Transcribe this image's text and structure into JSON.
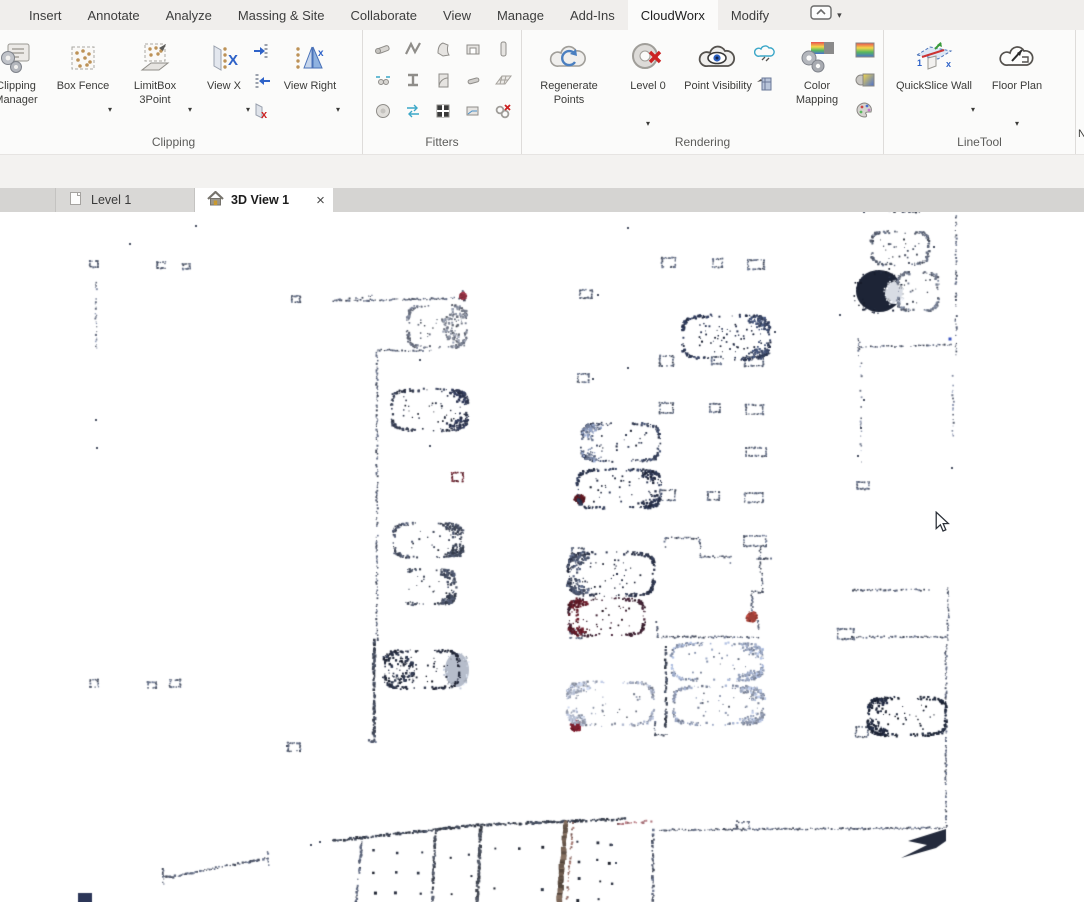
{
  "menu": {
    "tabs": [
      "Insert",
      "Annotate",
      "Analyze",
      "Massing & Site",
      "Collaborate",
      "View",
      "Manage",
      "Add-Ins",
      "CloudWorx",
      "Modify"
    ],
    "active_tab": "CloudWorx"
  },
  "ribbon": {
    "clipping": {
      "label": "Clipping",
      "manager": "Clipping Manager",
      "box_fence": "Box Fence",
      "limitbox": "LimitBox 3Point",
      "view_x": "View X",
      "view_right": "View Right"
    },
    "fitters": {
      "label": "Fitters"
    },
    "rendering": {
      "label": "Rendering",
      "regenerate": "Regenerate Points",
      "level": "Level 0",
      "visibility": "Point Visibility",
      "mapping": "Color Mapping"
    },
    "linetool": {
      "label": "LineTool",
      "quickslice": "QuickSlice Wall",
      "floorplan": "Floor Plan"
    },
    "edge_fragment": "N"
  },
  "view_tabs": {
    "level1": "Level 1",
    "view3d": "3D View 1",
    "close": "×"
  },
  "colors": {
    "accent_blue": "#2e62c8",
    "point_navy": "#2a3450",
    "tan_dot": "#bd9257",
    "red_mark": "#cc2222"
  },
  "scene": {
    "walls": [
      {
        "p": [
          330,
          301,
          464,
          298
        ]
      },
      {
        "p": [
          372,
          296,
          332,
          301
        ],
        "g": 0.55
      },
      {
        "p": [
          463,
          291,
          464,
          300
        ],
        "w": 2
      },
      {
        "p": [
          378,
          350,
          431,
          351
        ]
      },
      {
        "p": [
          377,
          351,
          377,
          640
        ],
        "g": 0.38
      },
      {
        "p": [
          374,
          640,
          374,
          741
        ],
        "w": 2.4,
        "g": 0.12,
        "c": "#3f4656"
      },
      {
        "p": [
          369,
          741,
          381,
          742
        ],
        "w": 2
      },
      {
        "p": [
          96,
          281,
          96,
          348
        ],
        "g": 0.5,
        "c": "#7a8296"
      },
      {
        "p": [
          956,
          216,
          956,
          358
        ],
        "g": 0.45
      },
      {
        "p": [
          953,
          358,
          953,
          460
        ],
        "g": 0.62,
        "c": "#7a8296"
      },
      {
        "p": [
          858,
          347,
          951,
          345
        ]
      },
      {
        "p": [
          859,
          339,
          859,
          359
        ],
        "g": 0.3
      },
      {
        "p": [
          878,
          210,
          921,
          212
        ],
        "w": 2,
        "g": 0.15,
        "c": "#3f4656"
      },
      {
        "p": [
          853,
          590,
          929,
          590
        ]
      },
      {
        "p": [
          948,
          588,
          948,
          640
        ]
      },
      {
        "p": [
          852,
          637,
          947,
          637
        ]
      },
      {
        "p": [
          946,
          645,
          946,
          829
        ],
        "g": 0.2
      },
      {
        "p": [
          655,
          830,
          944,
          828
        ],
        "g": 0.12
      },
      {
        "p": [
          737,
          822,
          749,
          822
        ]
      },
      {
        "p": [
          737,
          822,
          737,
          830
        ]
      },
      {
        "p": [
          749,
          822,
          749,
          830
        ]
      },
      {
        "p": [
          618,
          824,
          653,
          821
        ],
        "c": "#9a6a70",
        "w": 2
      },
      {
        "p": [
          653,
          830,
          653,
          902
        ],
        "g": 0.2,
        "w": 2
      },
      {
        "p": [
          175,
          876,
          268,
          858
        ],
        "w": 1.8,
        "g": 0.15
      },
      {
        "p": [
          163,
          876,
          175,
          877
        ],
        "w": 2
      },
      {
        "p": [
          163,
          869,
          163,
          884
        ]
      },
      {
        "p": [
          268,
          852,
          268,
          870
        ],
        "g": 0.3
      },
      {
        "p": [
          333,
          841,
          478,
          825
        ],
        "w": 2.2,
        "g": 0.1,
        "c": "#3a4150"
      },
      {
        "p": [
          478,
          825,
          625,
          819
        ],
        "w": 2.2,
        "g": 0.1,
        "c": "#3a4150"
      },
      {
        "p": [
          362,
          842,
          356,
          902
        ],
        "w": 2,
        "g": 0.2
      },
      {
        "p": [
          436,
          830,
          432,
          902
        ],
        "w": 2.2,
        "g": 0.15,
        "c": "#4a505e"
      },
      {
        "p": [
          481,
          827,
          477,
          902
        ],
        "w": 2.6,
        "g": 0.12,
        "c": "#454a55"
      },
      {
        "p": [
          566,
          822,
          559,
          902
        ],
        "w": 4,
        "g": 0.08,
        "c": "#6b5a4e"
      },
      {
        "p": [
          573,
          823,
          567,
          902
        ],
        "w": 1.6,
        "g": 0.4,
        "c": "#97706a"
      },
      {
        "p": [
          665,
          538,
          700,
          538
        ]
      },
      {
        "p": [
          700,
          538,
          700,
          557
        ]
      },
      {
        "p": [
          700,
          557,
          731,
          557
        ]
      },
      {
        "p": [
          731,
          557,
          731,
          563
        ],
        "g": 0.3
      },
      {
        "p": [
          760,
          546,
          760,
          572
        ],
        "g": 0.3
      },
      {
        "p": [
          757,
          559,
          771,
          558
        ]
      },
      {
        "p": [
          762,
          572,
          762,
          592
        ]
      },
      {
        "p": [
          752,
          592,
          762,
          592
        ]
      },
      {
        "p": [
          752,
          592,
          752,
          617
        ]
      },
      {
        "p": [
          752,
          621,
          758,
          621
        ]
      },
      {
        "p": [
          758,
          621,
          758,
          631
        ]
      },
      {
        "p": [
          657,
          637,
          760,
          637
        ]
      },
      {
        "p": [
          657,
          622,
          657,
          637
        ]
      },
      {
        "p": [
          665,
          538,
          665,
          547
        ]
      },
      {
        "p": [
          861,
          360,
          861,
          462
        ],
        "g": 0.72,
        "c": "#848ca0"
      },
      {
        "p": [
          666,
          647,
          666,
          727
        ],
        "w": 2,
        "g": 0.15,
        "c": "#3f4656"
      },
      {
        "p": [
          655,
          722,
          655,
          735
        ]
      },
      {
        "p": [
          655,
          735,
          667,
          735
        ]
      }
    ],
    "columns": [
      [
        662,
        258,
        13,
        9
      ],
      [
        713,
        259,
        9,
        8
      ],
      [
        748,
        260,
        16,
        9
      ],
      [
        580,
        290,
        12,
        8
      ],
      [
        578,
        374,
        11,
        8
      ],
      [
        660,
        356,
        13,
        10
      ],
      [
        712,
        357,
        9,
        7
      ],
      [
        745,
        357,
        18,
        9
      ],
      [
        660,
        403,
        13,
        10
      ],
      [
        710,
        404,
        10,
        8
      ],
      [
        746,
        405,
        17,
        9
      ],
      [
        746,
        448,
        20,
        8
      ],
      [
        660,
        490,
        15,
        10
      ],
      [
        708,
        492,
        11,
        8
      ],
      [
        745,
        493,
        18,
        9
      ],
      [
        572,
        548,
        12,
        9
      ],
      [
        570,
        630,
        12,
        8
      ],
      [
        744,
        536,
        22,
        10
      ],
      [
        838,
        629,
        16,
        10
      ],
      [
        856,
        727,
        12,
        10
      ],
      [
        90,
        261,
        8,
        6
      ],
      [
        157,
        262,
        8,
        6
      ],
      [
        183,
        264,
        7,
        5
      ],
      [
        292,
        296,
        8,
        6
      ],
      [
        90,
        680,
        8,
        7
      ],
      [
        148,
        682,
        8,
        6
      ],
      [
        170,
        680,
        10,
        7
      ],
      [
        288,
        743,
        12,
        8
      ],
      [
        857,
        482,
        12,
        7
      ],
      [
        452,
        473,
        11,
        8,
        "#6a2430"
      ]
    ],
    "blobs": [
      {
        "e": [
          457,
          670,
          12,
          17
        ],
        "c": "#b6bdcb"
      },
      {
        "e": [
          879,
          291,
          23,
          21
        ],
        "c": "#1d2436"
      },
      {
        "e": [
          894,
          293,
          9,
          11
        ],
        "c": "#d8dce4"
      },
      {
        "poly": [
          [
            946,
            829
          ],
          [
            908,
            841
          ],
          [
            927,
            845
          ],
          [
            901,
            858
          ],
          [
            936,
            848
          ],
          [
            946,
            841
          ]
        ],
        "c": "#232a3c"
      },
      {
        "poly": [
          [
            78,
            893
          ],
          [
            92,
            893
          ],
          [
            92,
            902
          ],
          [
            78,
            902
          ]
        ],
        "c": "#2c3658"
      },
      {
        "e": [
          576,
          726,
          5,
          5
        ],
        "c": "#7e2030"
      },
      {
        "e": [
          752,
          617,
          5,
          5
        ],
        "c": "#a04038"
      },
      {
        "e": [
          580,
          499,
          5,
          4
        ],
        "c": "#5c1822"
      },
      {
        "e": [
          463,
          296,
          3,
          3
        ],
        "c": "#8a3040"
      }
    ],
    "cars": [
      {
        "x": 683,
        "y": 316,
        "w": 86,
        "h": 43,
        "end": "right",
        "o": "#2a3450",
        "e": "#3a4766",
        "int": 26
      },
      {
        "x": 582,
        "y": 424,
        "w": 77,
        "h": 37,
        "end": "left",
        "o": "#3a445e",
        "e": "#7c89a6",
        "int": 10
      },
      {
        "x": 578,
        "y": 470,
        "w": 82,
        "h": 38,
        "end": "right",
        "o": "#2e3852",
        "e": "#262e46",
        "int": 12
      },
      {
        "x": 569,
        "y": 553,
        "w": 85,
        "h": 42,
        "end": "left",
        "o": "#2b3248",
        "e": "#4c566e",
        "int": 16,
        "nm": 2.2
      },
      {
        "x": 569,
        "y": 599,
        "w": 75,
        "h": 36,
        "end": "left",
        "o": "#3c2030",
        "e": "#5c1a26",
        "int": 10
      },
      {
        "x": 672,
        "y": 644,
        "w": 90,
        "h": 36,
        "end": "right",
        "o": "#8e9ab4",
        "e": "#96a2bc",
        "int": 8
      },
      {
        "x": 674,
        "y": 687,
        "w": 89,
        "h": 37,
        "end": "right",
        "o": "#8a94ac",
        "e": "#9aa4ba",
        "int": 10
      },
      {
        "x": 568,
        "y": 682,
        "w": 85,
        "h": 43,
        "end": "left",
        "o": "#9aa2b6",
        "e": "#aab2c4",
        "int": 12
      },
      {
        "x": 408,
        "y": 306,
        "w": 58,
        "h": 41,
        "end": "right",
        "o": "#6a7080",
        "e": "#7e8492",
        "int": 8,
        "fe": 1
      },
      {
        "x": 392,
        "y": 390,
        "w": 75,
        "h": 40,
        "end": "right",
        "o": "#353c50",
        "e": "#2c3450",
        "int": 14
      },
      {
        "x": 394,
        "y": 524,
        "w": 68,
        "h": 33,
        "end": "right",
        "o": "#4a5266",
        "e": "#3e4658",
        "int": 8
      },
      {
        "x": 400,
        "y": 570,
        "w": 55,
        "h": 34,
        "end": "right",
        "o": "#4e5668",
        "e": "#424a5e",
        "int": 6,
        "open": "left"
      },
      {
        "x": 385,
        "y": 651,
        "w": 74,
        "h": 37,
        "end": "left",
        "o": "#262c3e",
        "e": "#2a3246",
        "int": 18,
        "fe": 1
      },
      {
        "x": 898,
        "y": 273,
        "w": 40,
        "h": 37,
        "o": "#6a7284",
        "int": 6
      },
      {
        "x": 869,
        "y": 698,
        "w": 77,
        "h": 37,
        "end": "left",
        "o": "#1e2638",
        "e": "#222a40",
        "int": 14,
        "nm": 2.2
      },
      {
        "x": 872,
        "y": 232,
        "w": 56,
        "h": 32,
        "o": "#5a6274",
        "int": 10
      }
    ],
    "dotgrids": [
      {
        "x": 374,
        "y": 852,
        "dx": 23,
        "dy": 20,
        "cols": 3,
        "rows": 3
      },
      {
        "x": 451,
        "y": 856,
        "dx": 18,
        "dy": 20,
        "cols": 2,
        "rows": 3,
        "skip": 0.35
      },
      {
        "x": 496,
        "y": 848,
        "dx": 24,
        "dy": 20,
        "cols": 3,
        "rows": 3
      },
      {
        "x": 578,
        "y": 842,
        "dx": 21,
        "dy": 19,
        "cols": 2,
        "rows": 4
      },
      {
        "x": 610,
        "y": 846,
        "dx": 14,
        "dy": 18,
        "cols": 1,
        "rows": 3,
        "skip": 0.3
      }
    ],
    "specks": [
      [
        130,
        244
      ],
      [
        196,
        226
      ],
      [
        628,
        228
      ],
      [
        840,
        315
      ],
      [
        950,
        339,
        3,
        "#3a55c0"
      ],
      [
        864,
        400
      ],
      [
        861,
        428
      ],
      [
        858,
        456
      ],
      [
        612,
        845
      ],
      [
        616,
        863
      ],
      [
        311,
        845
      ],
      [
        320,
        842
      ],
      [
        250,
        862
      ],
      [
        598,
        295
      ],
      [
        775,
        332
      ],
      [
        628,
        368
      ],
      [
        593,
        379
      ],
      [
        864,
        212
      ],
      [
        934,
        247
      ],
      [
        952,
        468
      ],
      [
        96,
        420
      ],
      [
        97,
        448
      ],
      [
        287,
        746
      ],
      [
        420,
        360
      ],
      [
        430,
        446
      ]
    ],
    "cursor": {
      "x": 934,
      "y": 511
    }
  }
}
